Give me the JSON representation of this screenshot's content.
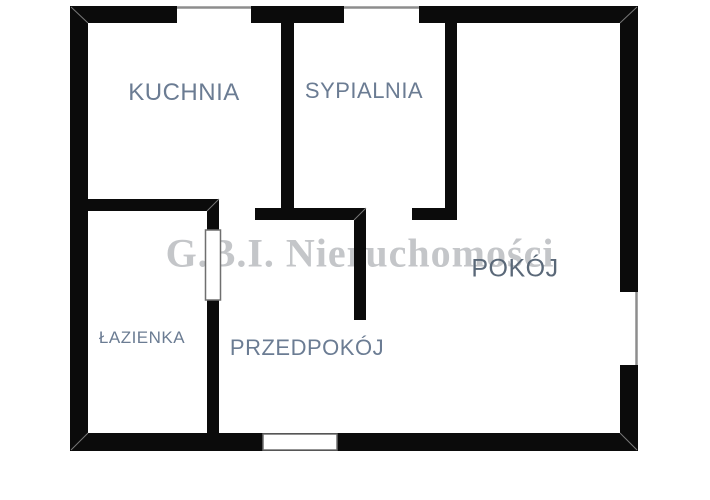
{
  "watermark": {
    "text": "G.B.I. Nieruchomości"
  },
  "rooms": [
    {
      "name": "kuchnia",
      "label": "KUCHNIA"
    },
    {
      "name": "sypialnia",
      "label": "SYPIALNIA"
    },
    {
      "name": "pokoj",
      "label": "POKÓJ"
    },
    {
      "name": "lazienka",
      "label": "ŁAZIENKA"
    },
    {
      "name": "przedpokoj",
      "label": "PRZEDPOKÓJ"
    }
  ],
  "colors": {
    "wall": "#0b0b0b",
    "floor": "#ffffff",
    "label": "#6b7c93",
    "pokoj_label": "#5a6878",
    "watermark": "#c4c6c9",
    "window_line": "#8d8d8d",
    "door_line": "#6f6f6f",
    "bevel_line": "#777777"
  }
}
